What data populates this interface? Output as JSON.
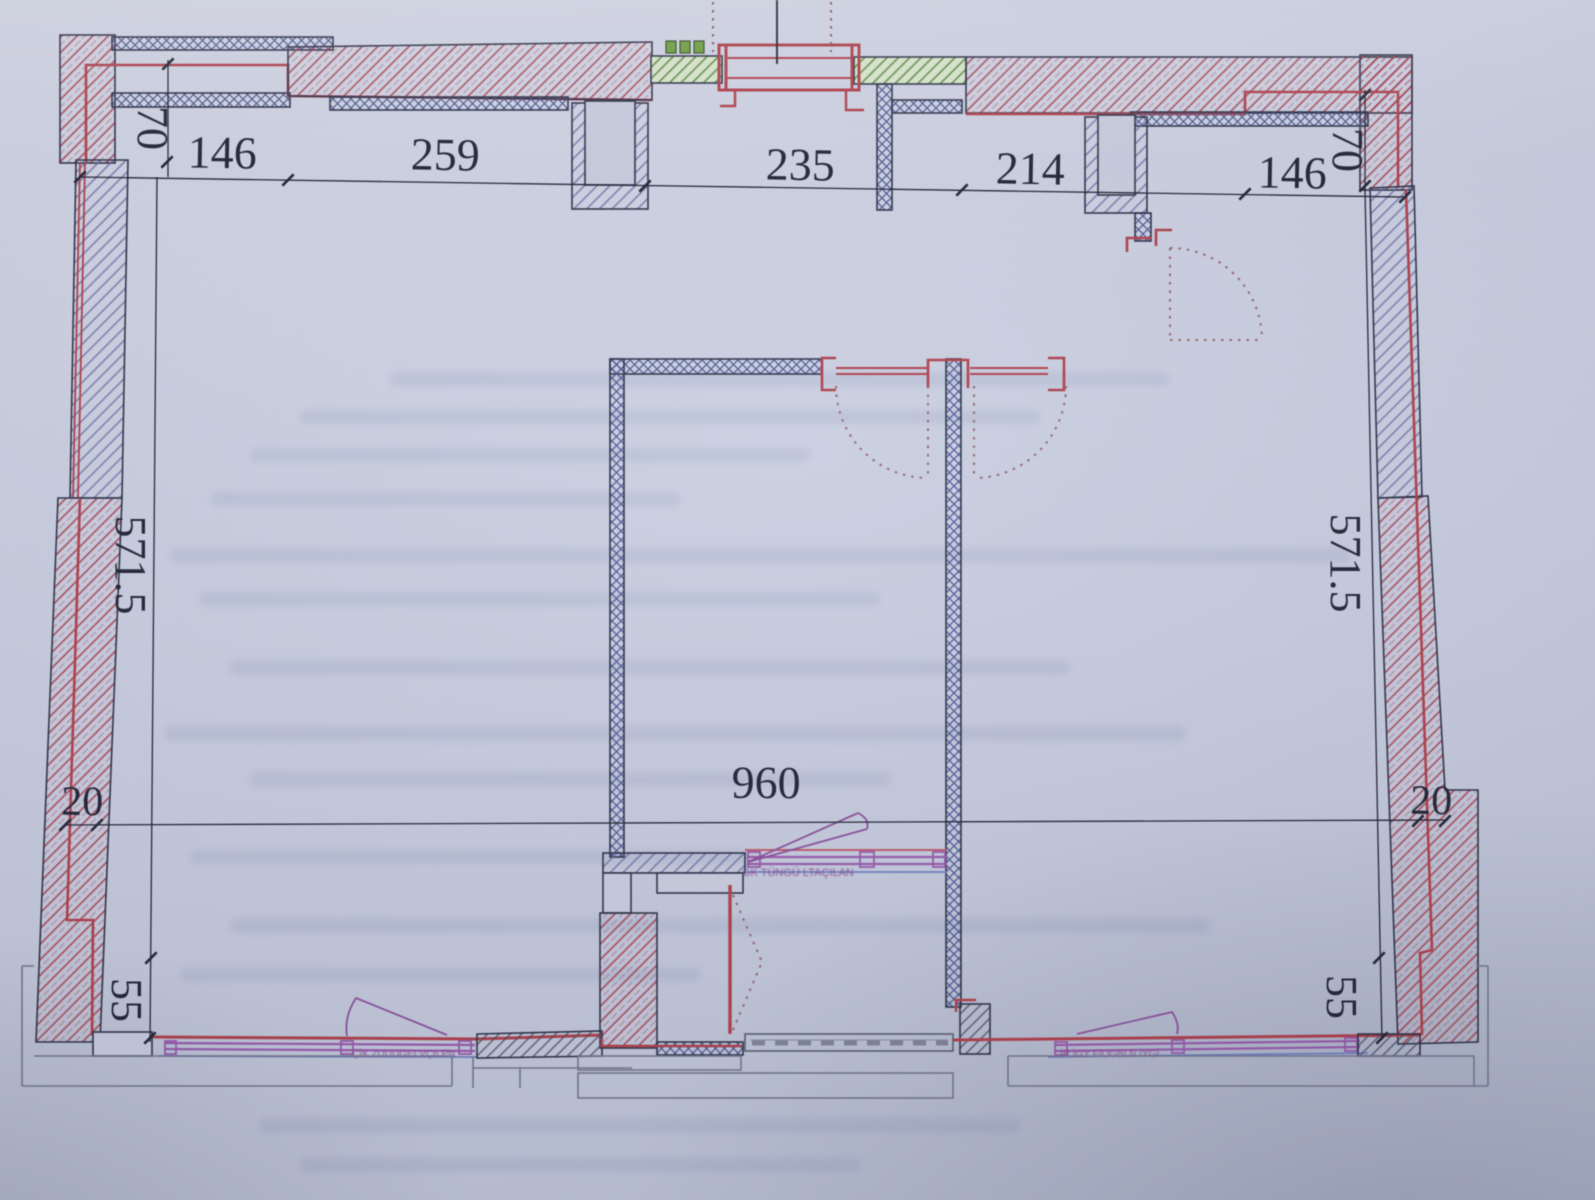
{
  "drawing": {
    "type": "apartment-floor-plan",
    "dimensions_top": [
      "146",
      "259",
      "235",
      "214",
      "146"
    ],
    "dimension_top_offset_left": "70",
    "dimension_top_offset_right": "70",
    "dimension_side_left": "571.5",
    "dimension_side_right": "571.5",
    "dimension_step_left": "20",
    "dimension_step_right": "20",
    "dimension_bottom_left": "55",
    "dimension_bottom_right": "55",
    "dimension_interior_width": "960",
    "label_balcony_door": "GK TÜNGÜ LTAÇILAN",
    "label_window_left": "ÇİK ZUUUGEI VÇ6 PN",
    "label_window_right": "İR İGY FIOGBLN İYGİ",
    "colors": {
      "paper": "#c9cde0",
      "ink": "#23263a",
      "wall_red": "#b23c48",
      "masonry_blue": "#41528f",
      "hatch_purple": "#62629e",
      "lintel_green": "#55873a",
      "glazing_purple": "#9757ad",
      "slab_gray": "#7d8294"
    }
  }
}
